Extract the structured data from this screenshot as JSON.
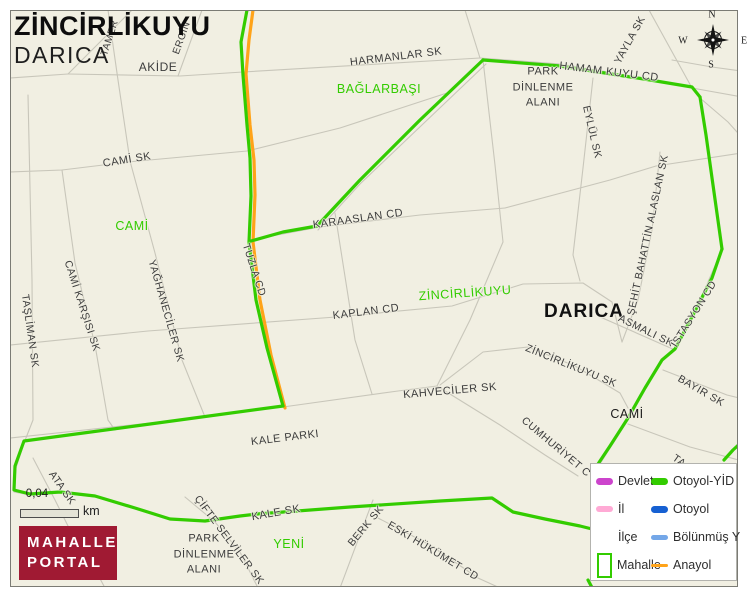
{
  "title": {
    "line1": "ZİNCİRLİKUYU",
    "line2": "DARICA"
  },
  "logo": {
    "line1": "MAHALLE",
    "line2": "PORTAL"
  },
  "scale": {
    "value": "0,04",
    "unit": "km"
  },
  "compass": {
    "n": "N",
    "e": "E",
    "s": "S",
    "w": "W"
  },
  "colors": {
    "background": "#f1efe2",
    "road": "#c8c6ba",
    "boundary_green": "#33cc00",
    "anayol_orange": "#ffa319",
    "devlet_magenta": "#cc44cc",
    "il_pink": "#ffaad5",
    "otoyol_blue": "#1660d2",
    "bolunmus_blue": "#74a7e8",
    "logo_red": "#a01a33",
    "label_green": "#33cc00",
    "label_dark": "#3c3c3c"
  },
  "map": {
    "labels": [
      {
        "text": "TAMER",
        "x": 110,
        "y": 38,
        "rot": -72,
        "size": 10
      },
      {
        "text": "ERGİN",
        "x": 182,
        "y": 38,
        "rot": -70,
        "size": 10
      },
      {
        "text": "AKİDE",
        "x": 158,
        "y": 67,
        "rot": 0,
        "size": 12
      },
      {
        "text": "HARMANLAR SK",
        "x": 396,
        "y": 57,
        "rot": -7,
        "size": 11
      },
      {
        "text": "HAMAM KUYU CD",
        "x": 609,
        "y": 72,
        "rot": 7,
        "size": 11
      },
      {
        "text": "YAYLA SK",
        "x": 630,
        "y": 40,
        "rot": -61,
        "size": 10.5
      },
      {
        "lines": [
          "PARK",
          "DİNLENME",
          "ALANI"
        ],
        "x": 543,
        "y": 88,
        "rot": 0,
        "size": 11
      },
      {
        "text": "EYLÜL SK",
        "x": 592,
        "y": 132,
        "rot": 77,
        "size": 10.5
      },
      {
        "text": "BAĞLARBAŞI",
        "x": 379,
        "y": 89,
        "rot": 0,
        "size": 12.5,
        "color": "#33cc00"
      },
      {
        "text": "CAMİ SK",
        "x": 127,
        "y": 160,
        "rot": -9,
        "size": 11
      },
      {
        "text": "CAMİ",
        "x": 132,
        "y": 226,
        "rot": 0,
        "size": 12.5,
        "color": "#33cc00"
      },
      {
        "text": "KARAASLAN CD",
        "x": 358,
        "y": 219,
        "rot": -8,
        "size": 11
      },
      {
        "text": "TUZLA CD",
        "x": 254,
        "y": 270,
        "rot": 72,
        "size": 10.5
      },
      {
        "text": "ZİNCİRLİKUYU",
        "x": 465,
        "y": 293,
        "rot": -4,
        "size": 12.5,
        "color": "#33cc00"
      },
      {
        "text": "DARICA",
        "x": 584,
        "y": 312,
        "rot": 0,
        "size": 19,
        "bold": true,
        "color": "#111111"
      },
      {
        "text": "KAPLAN CD",
        "x": 366,
        "y": 312,
        "rot": -7,
        "size": 11
      },
      {
        "text": "ŞEHİT BAHATTİN ALASLAN SK",
        "x": 648,
        "y": 235,
        "rot": -78,
        "size": 10.5
      },
      {
        "text": "ASMALI SK",
        "x": 646,
        "y": 331,
        "rot": 26,
        "size": 10.5
      },
      {
        "text": "İSTASYON CD",
        "x": 694,
        "y": 314,
        "rot": -58,
        "size": 10.5
      },
      {
        "text": "CAMİ KARŞISI SK",
        "x": 82,
        "y": 306,
        "rot": 72,
        "size": 10.5
      },
      {
        "text": "YAĞHANECİLER SK",
        "x": 166,
        "y": 311,
        "rot": 74,
        "size": 10.5
      },
      {
        "text": "TAŞLİMAN SK",
        "x": 30,
        "y": 331,
        "rot": 82,
        "size": 10.5
      },
      {
        "text": "ZİNCİRLİKUYU SK",
        "x": 571,
        "y": 366,
        "rot": 22,
        "size": 10.5
      },
      {
        "text": "KAHVECİLER SK",
        "x": 450,
        "y": 391,
        "rot": -5,
        "size": 11
      },
      {
        "text": "CAMİ",
        "x": 627,
        "y": 414,
        "rot": 0,
        "size": 12.5,
        "color": "#1a1a1a"
      },
      {
        "text": "BAYIR SK",
        "x": 701,
        "y": 391,
        "rot": 30,
        "size": 10.5
      },
      {
        "text": "CUMHURİYET C",
        "x": 556,
        "y": 447,
        "rot": 40,
        "size": 10.5
      },
      {
        "text": "KALE PARKI",
        "x": 285,
        "y": 438,
        "rot": -7,
        "size": 11
      },
      {
        "text": "ATA SK",
        "x": 62,
        "y": 488,
        "rot": 55,
        "size": 10.5
      },
      {
        "text": "KALE SK",
        "x": 276,
        "y": 513,
        "rot": -10,
        "size": 11
      },
      {
        "text": "YENİ",
        "x": 289,
        "y": 544,
        "rot": 0,
        "size": 12.5,
        "color": "#33cc00"
      },
      {
        "text": "BERK SK",
        "x": 366,
        "y": 526,
        "rot": -50,
        "size": 10.5
      },
      {
        "text": "ESKİ HÜKÜMET CD",
        "x": 433,
        "y": 551,
        "rot": 31,
        "size": 10.5
      },
      {
        "text": "ÇİFTE SELVİLER SK",
        "x": 229,
        "y": 540,
        "rot": 53,
        "size": 10.5
      },
      {
        "lines": [
          "PARK",
          "DİNLENME",
          "ALANI"
        ],
        "x": 204,
        "y": 555,
        "rot": 0,
        "size": 11
      },
      {
        "text": "TA",
        "x": 679,
        "y": 461,
        "rot": 35,
        "size": 10.5
      }
    ]
  },
  "legend": {
    "items": [
      {
        "label": "Devlet",
        "swatch": "line",
        "thick": 7,
        "color": "#cc44cc",
        "col": 1
      },
      {
        "label": "İl",
        "swatch": "line",
        "thick": 6,
        "color": "#ffaad5",
        "col": 1
      },
      {
        "label": "İlçe",
        "swatch": "none",
        "thick": 0,
        "color": "",
        "col": 1
      },
      {
        "label": "Mahalle",
        "swatch": "rect",
        "thick": 2,
        "color": "#33cc00",
        "col": 1
      },
      {
        "label": "Otoyol-YİD",
        "swatch": "line",
        "thick": 7,
        "color": "#33cc00",
        "col": 2
      },
      {
        "label": "Otoyol",
        "swatch": "line",
        "thick": 7,
        "color": "#1660d2",
        "col": 2
      },
      {
        "label": "Bölünmüş Y",
        "swatch": "line",
        "thick": 5,
        "color": "#74a7e8",
        "col": 2
      },
      {
        "label": "Anayol",
        "swatch": "line",
        "thick": 3,
        "color": "#ffa319",
        "col": 2
      }
    ]
  }
}
